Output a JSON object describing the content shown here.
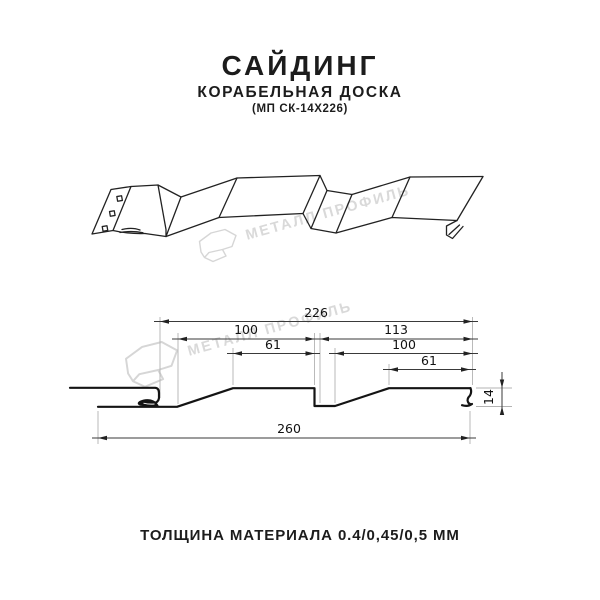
{
  "header": {
    "title": "САЙДИНГ",
    "subtitle": "КОРАБЕЛЬНАЯ ДОСКА",
    "model": "(МП СК-14Х226)"
  },
  "watermark": {
    "text": "МЕТАЛЛ ПРОФИЛЬ",
    "color": "#d9d9d9"
  },
  "drawing": {
    "type": "technical profile drawing",
    "views": [
      "3d perspective of siding panel",
      "cross-section with dimensions"
    ],
    "line_color": "#141414"
  },
  "dims": {
    "overall_top": "226",
    "left_span": "100",
    "right_span": "113",
    "left_flat": "61",
    "right_inner_span": "100",
    "right_flat": "61",
    "overall_bottom": "260",
    "profile_height": "14"
  },
  "footer": {
    "text": "ТОЛЩИНА МАТЕРИАЛА 0.4/0,45/0,5 ММ"
  }
}
